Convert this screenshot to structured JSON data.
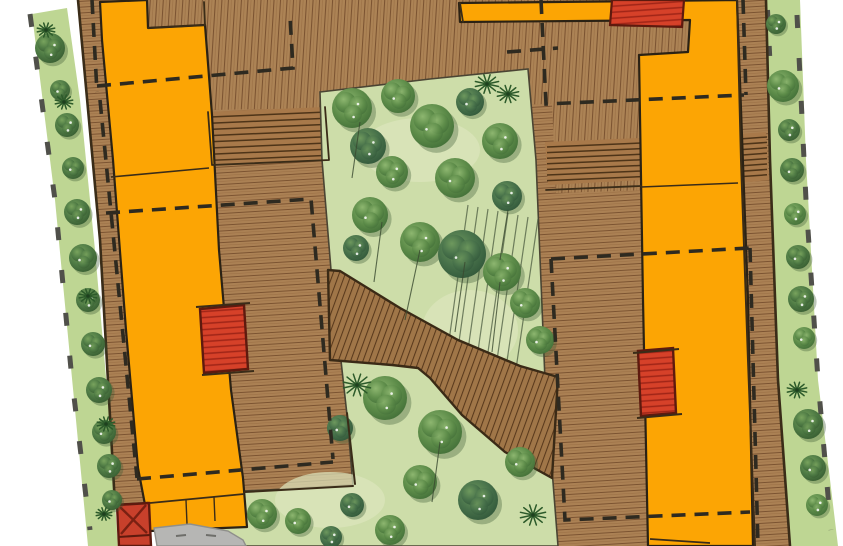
{
  "document": {
    "type": "landscape masterplan site plan",
    "rendering": "hand-drawn colored plan illustration",
    "visible_text": ""
  },
  "palette": {
    "background": "#ffffff",
    "deck_wood": "#ac8355",
    "deck_plank_line": "#7b5331",
    "deck_outline": "#3a2c18",
    "building_orange": "#fca504",
    "orange_outline": "#2b2214",
    "garden_base": "#cddda9",
    "garden_patch": "#dde6bd",
    "grass_strip": "#bed693",
    "tree_dark": "#3f6b36",
    "tree_mid": "#5d8c49",
    "tree_light": "#8fb871",
    "ramp_wood": "#a07648",
    "ramp_line": "#59391c",
    "stair_wood": "#a8794a",
    "stair_line": "#4e3418",
    "red_fill": "#d64129",
    "red_stripe": "#a02517",
    "red_outline": "#5e1a0e",
    "dash_line": "#2e2a20",
    "edge_mark": "#50504a",
    "path_gray": "#b6b6b4",
    "path_edge": "#8f8f8b",
    "trunk_line": "#3a4a30"
  },
  "legend": {
    "orange_regions": "building footprint / terrace",
    "brown_regions": "timber boardwalk deck",
    "central_green": "courtyard tree garden",
    "edge_greens": "perimeter planting strips",
    "dashed_lines": "canopy / roof overhang outline",
    "red_elements": "stairs and site furniture",
    "gray_region": "footpath"
  },
  "vegetation": {
    "courtyard_trees": [
      {
        "x": 352,
        "y": 108,
        "r": 20
      },
      {
        "x": 398,
        "y": 96,
        "r": 17
      },
      {
        "x": 368,
        "y": 146,
        "r": 18
      },
      {
        "x": 432,
        "y": 126,
        "r": 22
      },
      {
        "x": 392,
        "y": 172,
        "r": 16
      },
      {
        "x": 470,
        "y": 102,
        "r": 14
      },
      {
        "x": 500,
        "y": 141,
        "r": 18
      },
      {
        "x": 455,
        "y": 178,
        "r": 20
      },
      {
        "x": 507,
        "y": 196,
        "r": 15
      },
      {
        "x": 370,
        "y": 215,
        "r": 18
      },
      {
        "x": 420,
        "y": 242,
        "r": 20
      },
      {
        "x": 462,
        "y": 254,
        "r": 24
      },
      {
        "x": 502,
        "y": 272,
        "r": 19
      },
      {
        "x": 525,
        "y": 303,
        "r": 15
      },
      {
        "x": 356,
        "y": 248,
        "r": 13
      },
      {
        "x": 540,
        "y": 340,
        "r": 14
      },
      {
        "x": 385,
        "y": 398,
        "r": 22
      },
      {
        "x": 340,
        "y": 428,
        "r": 13
      },
      {
        "x": 440,
        "y": 432,
        "r": 22
      },
      {
        "x": 420,
        "y": 482,
        "r": 17
      },
      {
        "x": 478,
        "y": 500,
        "r": 20
      },
      {
        "x": 520,
        "y": 462,
        "r": 15
      },
      {
        "x": 390,
        "y": 530,
        "r": 15
      },
      {
        "x": 352,
        "y": 505,
        "r": 12
      },
      {
        "x": 262,
        "y": 514,
        "r": 15
      },
      {
        "x": 298,
        "y": 521,
        "r": 13
      },
      {
        "x": 331,
        "y": 537,
        "r": 11
      }
    ],
    "left_strip_plants": [
      {
        "x": 50,
        "y": 48,
        "r": 15
      },
      {
        "x": 60,
        "y": 90,
        "r": 10
      },
      {
        "x": 67,
        "y": 125,
        "r": 12
      },
      {
        "x": 73,
        "y": 168,
        "r": 11
      },
      {
        "x": 77,
        "y": 212,
        "r": 13
      },
      {
        "x": 83,
        "y": 258,
        "r": 14
      },
      {
        "x": 88,
        "y": 300,
        "r": 12
      },
      {
        "x": 93,
        "y": 344,
        "r": 12
      },
      {
        "x": 99,
        "y": 390,
        "r": 13
      },
      {
        "x": 104,
        "y": 432,
        "r": 12
      },
      {
        "x": 109,
        "y": 466,
        "r": 12
      },
      {
        "x": 112,
        "y": 500,
        "r": 10
      }
    ],
    "right_strip_plants": [
      {
        "x": 776,
        "y": 24,
        "r": 10
      },
      {
        "x": 783,
        "y": 86,
        "r": 16
      },
      {
        "x": 789,
        "y": 130,
        "r": 11
      },
      {
        "x": 792,
        "y": 170,
        "r": 12
      },
      {
        "x": 795,
        "y": 214,
        "r": 11
      },
      {
        "x": 798,
        "y": 257,
        "r": 12
      },
      {
        "x": 801,
        "y": 299,
        "r": 13
      },
      {
        "x": 804,
        "y": 338,
        "r": 11
      },
      {
        "x": 808,
        "y": 424,
        "r": 15
      },
      {
        "x": 813,
        "y": 468,
        "r": 13
      },
      {
        "x": 817,
        "y": 505,
        "r": 11
      }
    ],
    "palms": [
      {
        "x": 487,
        "y": 84,
        "r": 12
      },
      {
        "x": 508,
        "y": 94,
        "r": 11
      },
      {
        "x": 357,
        "y": 385,
        "r": 14
      },
      {
        "x": 533,
        "y": 515,
        "r": 13
      },
      {
        "x": 46,
        "y": 30,
        "r": 9
      },
      {
        "x": 64,
        "y": 102,
        "r": 9
      },
      {
        "x": 88,
        "y": 296,
        "r": 9
      },
      {
        "x": 106,
        "y": 424,
        "r": 9
      },
      {
        "x": 797,
        "y": 390,
        "r": 10
      },
      {
        "x": 104,
        "y": 514,
        "r": 8
      }
    ],
    "trunk_strokes": [
      [
        420,
        250,
        405,
        320
      ],
      [
        465,
        262,
        455,
        332
      ],
      [
        500,
        282,
        492,
        352
      ],
      [
        382,
        222,
        374,
        282
      ],
      [
        440,
        442,
        432,
        502
      ],
      [
        360,
        122,
        352,
        178
      ],
      [
        508,
        210,
        500,
        260
      ]
    ]
  }
}
